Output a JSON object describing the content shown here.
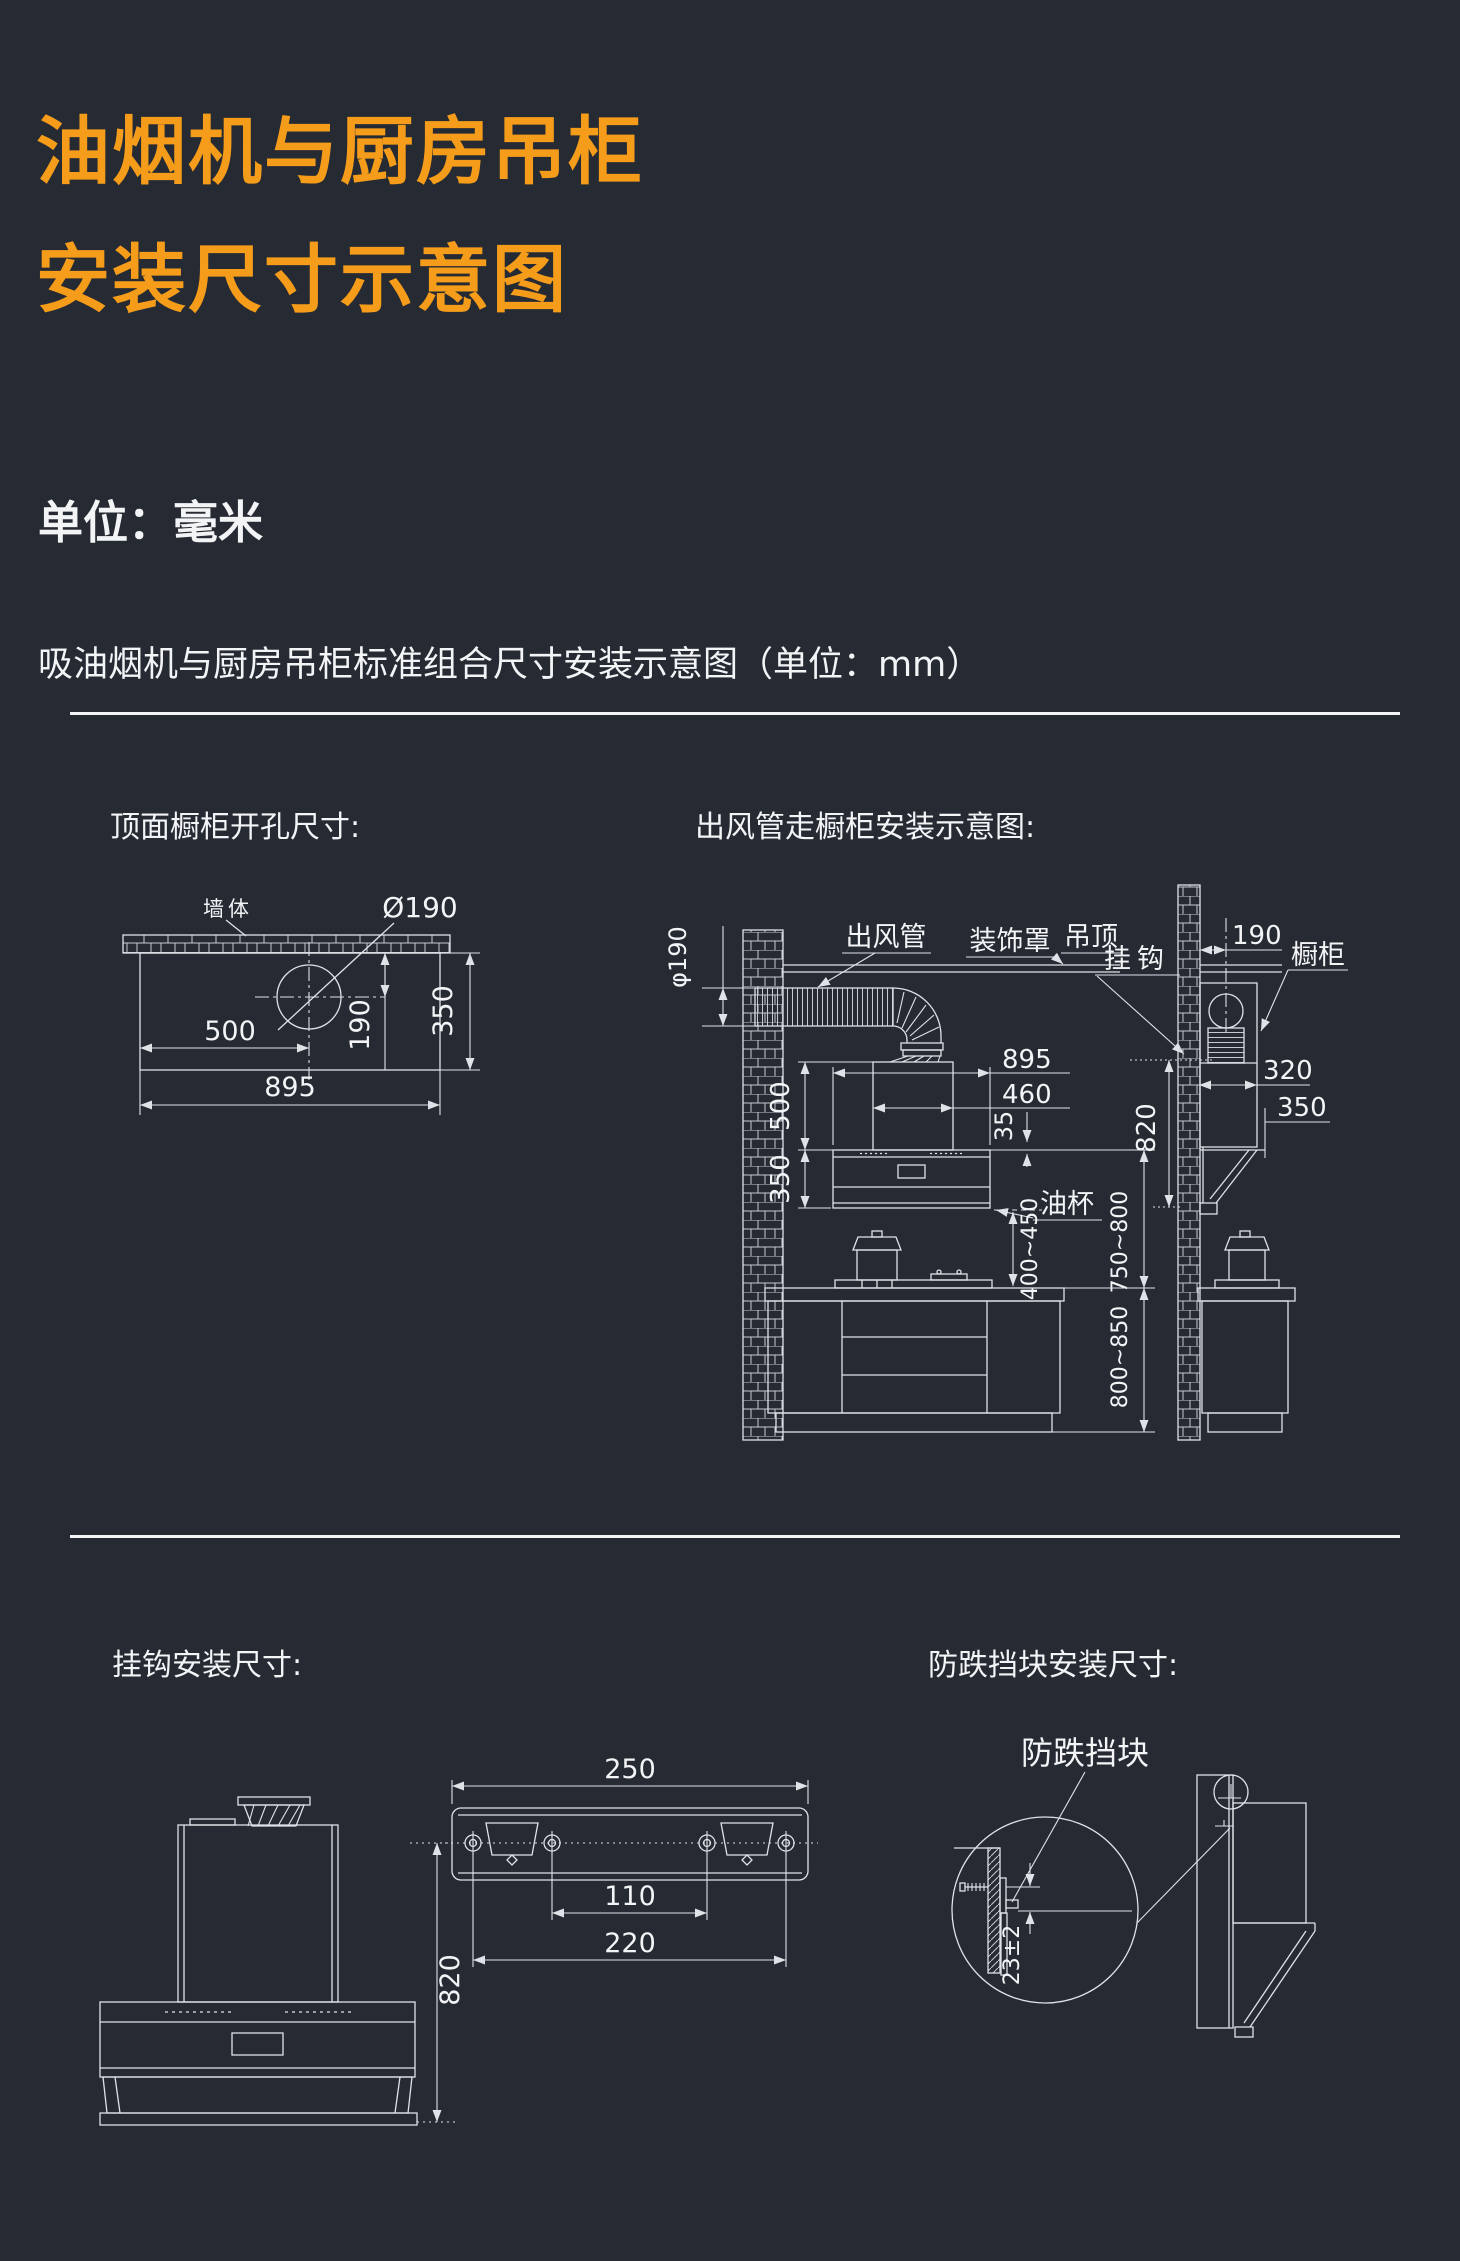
{
  "page": {
    "bg": "#262a33",
    "accent": "#f59d1a",
    "ink": "#f2f4f6",
    "line_color": "#dfe3e8",
    "title_line1": "油烟机与厨房吊柜",
    "title_line2": "安装尺寸示意图",
    "unit_label": "单位：毫米",
    "section_header": "吸油烟机与厨房吊柜标准组合尺寸安装示意图（单位：mm）"
  },
  "top_cutout": {
    "title": "顶面橱柜开孔尺寸:",
    "labels": {
      "wall": "墙体",
      "hole_dia": "Ø190"
    },
    "dims": {
      "left_to_center": "500",
      "total_width": "895",
      "center_offset": "190",
      "depth": "350"
    }
  },
  "duct_install": {
    "title": "出风管走橱柜安装示意图:",
    "labels": {
      "duct": "出风管",
      "cover": "装饰罩",
      "ceiling": "吊顶",
      "hook": "挂钩",
      "cabinet": "橱柜",
      "oil_cup": "油杯"
    },
    "dims": {
      "duct_dia": "φ190",
      "hood_width": "895",
      "cover_width": "460",
      "cover_overlap": "35",
      "cover_height": "500",
      "hood_height": "350",
      "hood_to_counter": "400~450",
      "hood_top_to_counter": "750~800",
      "hook_height_side": "820",
      "wall_to_duct": "190",
      "cabinet_depth": "320",
      "hood_depth": "350",
      "counter_height": "800~850"
    }
  },
  "hook_install": {
    "title": "挂钩安装尺寸:",
    "dims": {
      "bracket_width": "250",
      "inner_hole_spacing": "110",
      "outer_hole_spacing": "220",
      "hook_height": "820"
    }
  },
  "stopper_install": {
    "title": "防跌挡块安装尺寸:",
    "labels": {
      "stopper": "防跌挡块"
    },
    "dims": {
      "stopper_offset": "23±2"
    }
  }
}
